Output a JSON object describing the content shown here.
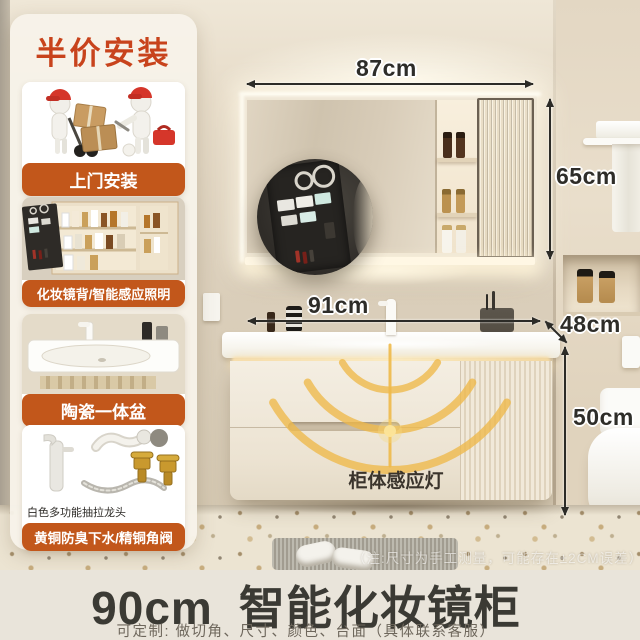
{
  "sidebar": {
    "badge": "半价安装",
    "cards": [
      {
        "label": "上门安装"
      },
      {
        "label": "化妆镜背/智能感应照明"
      },
      {
        "label": "陶瓷一体盆"
      },
      {
        "label": "黄铜防臭下水/精铜角阀",
        "caption": "白色多功能抽拉龙头"
      }
    ]
  },
  "annotations": {
    "mirror_width": "87cm",
    "mirror_height": "65cm",
    "vanity_width": "91cm",
    "vanity_depth": "48cm",
    "vanity_height": "50cm",
    "sensor_light": "柜体感应灯",
    "note": "（注:尺寸为手工测量，可能存在±2CM误差）"
  },
  "footer": {
    "size": "90cm",
    "product": "智能化妆镜柜",
    "customize": "可定制: 做切角、尺寸、颜色、台面（具体联系客服）"
  },
  "colors": {
    "accent_orange": "#c2571b",
    "badge_red": "#c8431c",
    "footer_bg": "#e9e4da",
    "dim_arrow": "#2c2b27",
    "sensor_yellow": "#eeb949"
  }
}
